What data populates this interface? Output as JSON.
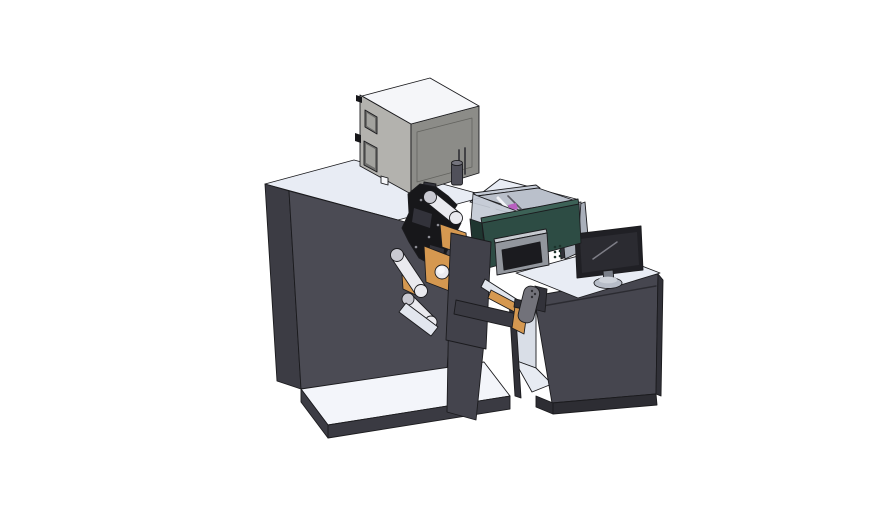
{
  "scene": {
    "type": "3d-cad-render",
    "subject": "industrial label printing and rewinding machine line with top exhaust unit, web rollers, color printer module and operator desk with monitor",
    "background": "plain white, no visible text"
  },
  "colors": {
    "background": "#ffffff",
    "surface_top": "#e8ecf4",
    "surface_bright": "#f3f5fa",
    "cabinet_front": "#4b4b54",
    "cabinet_side": "#3c3c44",
    "cabinet_lower": "#44444d",
    "base_band": "#3a3a42",
    "box_top": "#f5f6f9",
    "box_left": "#b3b2ae",
    "box_front": "#8c8c88",
    "box_window": "#6e6e6c",
    "box_window_inner": "#a2a29e",
    "roller": "#eaeaef",
    "roller_dim": "#c9c9d1",
    "plate_gray": "#41414a",
    "orange": "#d59850",
    "printer_green": "#2d4c44",
    "printer_green_dark": "#1f3630",
    "printer_green_light": "#3d6257",
    "panel_gray": "#92969d",
    "panel_top": "#c7cad0",
    "screen_dark": "#1b1b1f",
    "hopper_wall": "#c4cad5",
    "hopper_wall2": "#b3b9c5",
    "hopper_floor": "#bac0cb",
    "magenta": "#b95fc0",
    "monitor_body": "#202025",
    "monitor_screen": "#2b2b31",
    "monitor_base": "#b7bdc8",
    "monitor_base_top": "#cdd2da",
    "monitor_neck": "#7a7f89",
    "panel_back": "#a9afba",
    "paddle": "#72727a",
    "mech_black": "#17171a",
    "mech_mid": "#32323a",
    "bridge_beam": "#3a3a42",
    "bay_wall": "#d9dee7",
    "bay_floor": "#e7ebf2",
    "desk_front": "#46464f",
    "desk_plinth": "#2d2d33",
    "desk_side": "#313138",
    "white_plate": "#e2e6ee",
    "cylinder": "#50505a",
    "cylinder_top": "#74747e"
  }
}
